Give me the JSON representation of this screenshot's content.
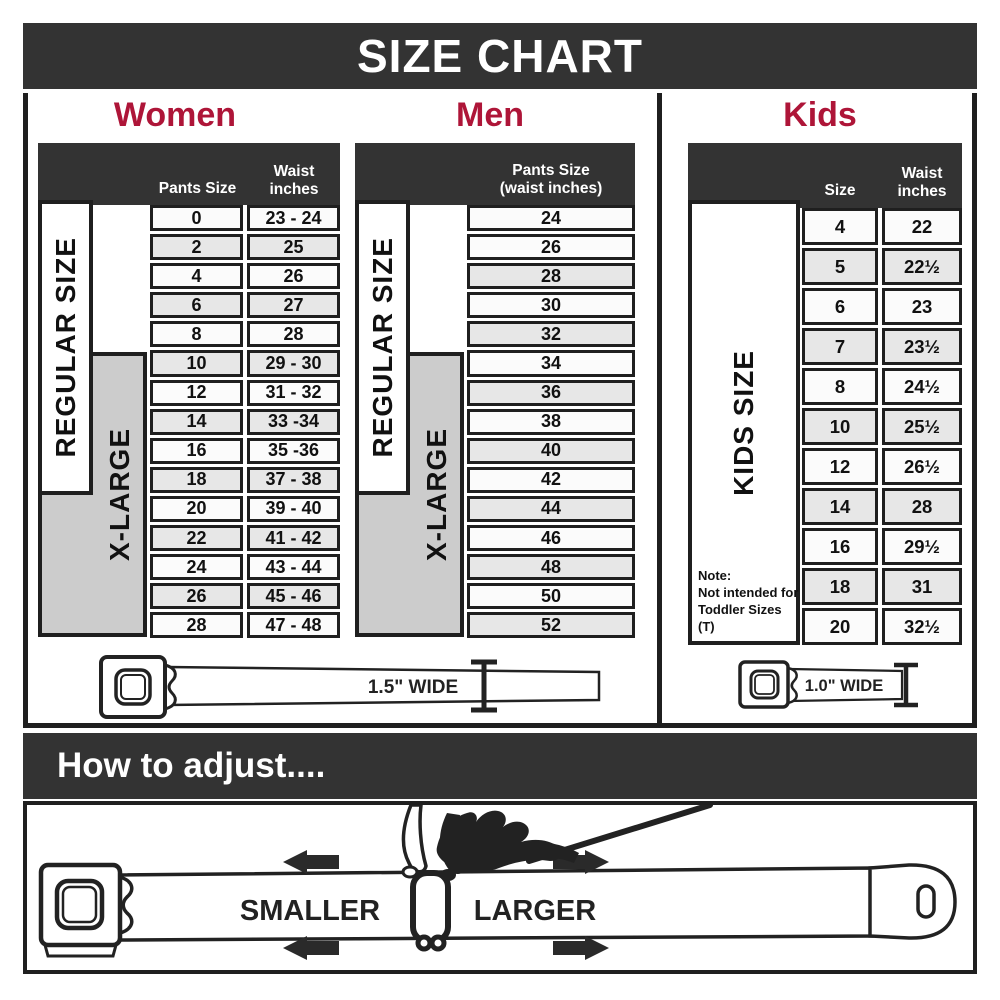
{
  "title": "SIZE CHART",
  "colors": {
    "accent": "#ae1538",
    "dark_bar": "#333333",
    "xlarge_gray": "#cccccc",
    "row_shade": "#e7e7e7",
    "border": "#1f1f1f"
  },
  "women": {
    "heading": "Women",
    "pants_header": "Pants Size",
    "waist_header_1": "Waist",
    "waist_header_2": "inches",
    "regular_label": "REGULAR SIZE",
    "xlarge_label": "X-LARGE",
    "rows": [
      {
        "size": "0",
        "waist": "23 - 24",
        "shade": false
      },
      {
        "size": "2",
        "waist": "25",
        "shade": true
      },
      {
        "size": "4",
        "waist": "26",
        "shade": false
      },
      {
        "size": "6",
        "waist": "27",
        "shade": true
      },
      {
        "size": "8",
        "waist": "28",
        "shade": false
      },
      {
        "size": "10",
        "waist": "29 - 30",
        "shade": true
      },
      {
        "size": "12",
        "waist": "31 - 32",
        "shade": false
      },
      {
        "size": "14",
        "waist": "33 -34",
        "shade": true
      },
      {
        "size": "16",
        "waist": "35 -36",
        "shade": false
      },
      {
        "size": "18",
        "waist": "37 - 38",
        "shade": true
      },
      {
        "size": "20",
        "waist": "39 - 40",
        "shade": false
      },
      {
        "size": "22",
        "waist": "41 - 42",
        "shade": true
      },
      {
        "size": "24",
        "waist": "43 - 44",
        "shade": false
      },
      {
        "size": "26",
        "waist": "45 - 46",
        "shade": true
      },
      {
        "size": "28",
        "waist": "47 - 48",
        "shade": false
      }
    ]
  },
  "men": {
    "heading": "Men",
    "header_1": "Pants Size",
    "header_2": "(waist inches)",
    "regular_label": "REGULAR SIZE",
    "xlarge_label": "X-LARGE",
    "rows": [
      {
        "value": "24",
        "shade": false
      },
      {
        "value": "26",
        "shade": false
      },
      {
        "value": "28",
        "shade": true
      },
      {
        "value": "30",
        "shade": false
      },
      {
        "value": "32",
        "shade": true
      },
      {
        "value": "34",
        "shade": false
      },
      {
        "value": "36",
        "shade": true
      },
      {
        "value": "38",
        "shade": false
      },
      {
        "value": "40",
        "shade": true
      },
      {
        "value": "42",
        "shade": false
      },
      {
        "value": "44",
        "shade": true
      },
      {
        "value": "46",
        "shade": false
      },
      {
        "value": "48",
        "shade": true
      },
      {
        "value": "50",
        "shade": false
      },
      {
        "value": "52",
        "shade": true
      }
    ]
  },
  "kids": {
    "heading": "Kids",
    "size_header": "Size",
    "waist_header_1": "Waist",
    "waist_header_2": "inches",
    "label": "KIDS SIZE",
    "note_line_1": "Note:",
    "note_line_2": "Not intended for",
    "note_line_3": "Toddler Sizes (T)",
    "rows": [
      {
        "size": "4",
        "waist": "22",
        "shade": false
      },
      {
        "size": "5",
        "waist": "22½",
        "shade": true
      },
      {
        "size": "6",
        "waist": "23",
        "shade": false
      },
      {
        "size": "7",
        "waist": "23½",
        "shade": true
      },
      {
        "size": "8",
        "waist": "24½",
        "shade": false
      },
      {
        "size": "10",
        "waist": "25½",
        "shade": true
      },
      {
        "size": "12",
        "waist": "26½",
        "shade": false
      },
      {
        "size": "14",
        "waist": "28",
        "shade": true
      },
      {
        "size": "16",
        "waist": "29½",
        "shade": false
      },
      {
        "size": "18",
        "waist": "31",
        "shade": true
      },
      {
        "size": "20",
        "waist": "32½",
        "shade": false
      }
    ]
  },
  "belts": {
    "adult_width": "1.5\" WIDE",
    "kids_width": "1.0\" WIDE"
  },
  "adjust": {
    "heading": "How to adjust....",
    "smaller": "SMALLER",
    "larger": "LARGER"
  }
}
